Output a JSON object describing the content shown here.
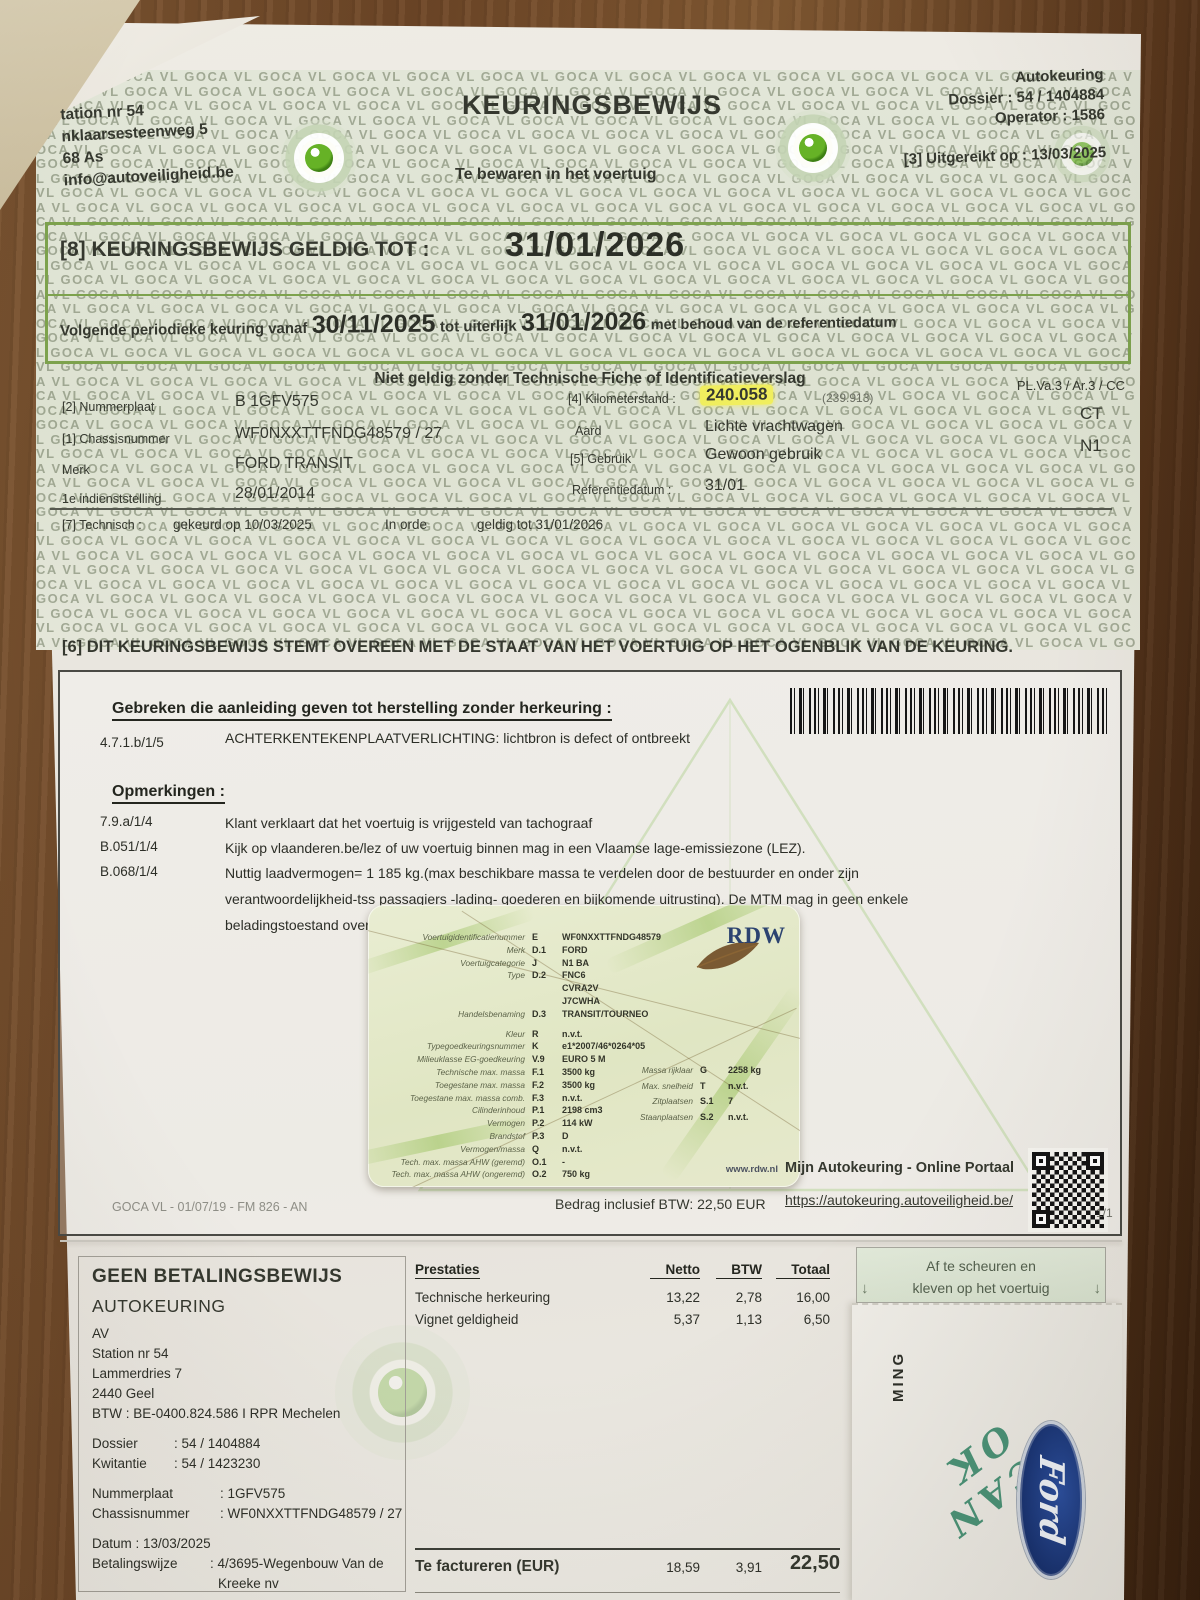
{
  "watermark": {
    "pattern_text": "GOCA VL"
  },
  "header": {
    "station_lines": [
      "tation nr 54",
      "nklaarsesteenweg 5",
      "68 As",
      "info@autoveiligheid.be"
    ],
    "title": "KEURINGSBEWIJS",
    "subtitle": "Te bewaren in het voertuig",
    "org": "Autokeuring",
    "dossier": "Dossier : 54 / 1404884",
    "operator": "Operator : 1586",
    "issued": "[3] Uitgereikt op : 13/03/2025"
  },
  "validity": {
    "label": "[8] KEURINGSBEWIJS GELDIG TOT :",
    "valid_until": "31/01/2026",
    "next_prefix": "Volgende periodieke keuring vanaf",
    "next_from": "30/11/2025",
    "next_mid": "tot uiterlijk",
    "next_until": "31/01/2026",
    "next_suffix": "met behoud van de referentiedatum"
  },
  "notice": "Niet geldig zonder Technische Fiche of Identificatieverslag",
  "vehicle": {
    "plate_label": "[2] Nummerplaat",
    "plate": "B 1GFV575",
    "km_label": "[4] Kilometerstand :",
    "km": "240.058",
    "km_prev": "(239.913)",
    "class_code": "PL.Va.3 / Ar.3 / CC",
    "ct": "CT",
    "n1": "N1",
    "chassis_label": "[1] Chassisnummer",
    "chassis": "WF0NXXTTFNDG48579 / 27",
    "aard_label": "Aard",
    "aard": "Lichte vrachtwagen",
    "merk_label": "Merk",
    "merk": "FORD TRANSIT",
    "gebruik_label": "[5] Gebruik",
    "gebruik": "Gewoon gebruik",
    "firstuse_label": "1e indienststelling",
    "firstuse": "28/01/2014",
    "ref_label": "Referentiedatum :",
    "ref": "31/01"
  },
  "technisch": {
    "label": "[7] Technisch :",
    "gekeurd": "gekeurd op 10/03/2025",
    "status": "In orde",
    "geldig": "geldig tot 31/01/2026"
  },
  "statement": "[6] DIT KEURINGSBEWIJS STEMT OVEREEN MET DE STAAT VAN HET VOERTUIG OP HET OGENBLIK VAN DE KEURING.",
  "defects": {
    "title": "Gebreken die aanleiding geven tot herstelling zonder herkeuring :",
    "rows": [
      {
        "code": "4.7.1.b/1/5",
        "text": "ACHTERKENTEKENPLAATVERLICHTING: lichtbron is defect of ontbreekt"
      }
    ]
  },
  "remarks": {
    "title": "Opmerkingen :",
    "rows": [
      {
        "code": "7.9.a/1/4",
        "text": "Klant verklaart dat het voertuig is vrijgesteld van tachograaf"
      },
      {
        "code": "B.051/1/4",
        "text": "Kijk op vlaanderen.be/lez of uw voertuig binnen mag in een Vlaamse lage-emissiezone (LEZ)."
      },
      {
        "code": "B.068/1/4",
        "text": "Nuttig laadvermogen= 1 185 kg.(max beschikbare massa te verdelen door de bestuurder en onder zijn verantwoordelijkheid-tss passagiers -lading- goederen en bijkomende uitrusting). De MTM mag in geen enkele beladingstoestand overschreden worden."
      }
    ]
  },
  "rdw_card": {
    "brand": "RDW",
    "website": "www.rdw.nl",
    "left_rows": [
      {
        "label": "Voertuigidentificatienummer",
        "code": "E",
        "value": "WF0NXXTTFNDG48579"
      },
      {
        "label": "Merk",
        "code": "D.1",
        "value": "FORD"
      },
      {
        "label": "Voertuigcategorie",
        "code": "J",
        "value": "N1 BA"
      },
      {
        "label": "Type",
        "code": "D.2",
        "value": "FNC6"
      },
      {
        "label": "",
        "code": "",
        "value": "CVRA2V"
      },
      {
        "label": "",
        "code": "",
        "value": "J7CWHA"
      },
      {
        "label": "Handelsbenaming",
        "code": "D.3",
        "value": "TRANSIT/TOURNEO"
      },
      {
        "label": "Kleur",
        "code": "R",
        "value": "n.v.t."
      },
      {
        "label": "Typegoedkeuringsnummer",
        "code": "K",
        "value": "e1*2007/46*0264*05"
      },
      {
        "label": "Milieuklasse EG-goedkeuring",
        "code": "V.9",
        "value": "EURO 5 M"
      },
      {
        "label": "Technische max. massa",
        "code": "F.1",
        "value": "3500 kg"
      },
      {
        "label": "Toegestane max. massa",
        "code": "F.2",
        "value": "3500 kg"
      },
      {
        "label": "Toegestane max. massa comb.",
        "code": "F.3",
        "value": "n.v.t."
      },
      {
        "label": "Cilinderinhoud",
        "code": "P.1",
        "value": "2198 cm3"
      },
      {
        "label": "Vermogen",
        "code": "P.2",
        "value": "114 kW"
      },
      {
        "label": "Brandstof",
        "code": "P.3",
        "value": "D"
      },
      {
        "label": "Vermogen/massa",
        "code": "Q",
        "value": "n.v.t."
      },
      {
        "label": "Tech. max. massa AHW (geremd)",
        "code": "O.1",
        "value": "-"
      },
      {
        "label": "Tech. max. massa AHW (ongeremd)",
        "code": "O.2",
        "value": "750 kg"
      }
    ],
    "right_rows": [
      {
        "label": "Massa rijklaar",
        "code": "G",
        "value": "2258 kg"
      },
      {
        "label": "Max. snelheid",
        "code": "T",
        "value": "n.v.t."
      },
      {
        "label": "Zitplaatsen",
        "code": "S.1",
        "value": "7"
      },
      {
        "label": "Staanplaatsen",
        "code": "S.2",
        "value": "n.v.t."
      }
    ]
  },
  "footer": {
    "bedrag": "Bedrag inclusief BTW: 22,50 EUR",
    "portal_title": "Mijn Autokeuring - Online Portaal",
    "portal_url": "https://autokeuring.autoveiligheid.be/",
    "page": "1/1",
    "form_ref": "GOCA VL - 01/07/19 - FM 826 - AN"
  },
  "receipt": {
    "no_proof": "GEEN BETALINGSBEWIJS",
    "org": "AUTOKEURING",
    "av": "AV",
    "address": [
      "Station nr 54",
      "Lammerdries 7",
      "2440 Geel"
    ],
    "btw": "BTW : BE-0400.824.586 I RPR Mechelen",
    "dossier_label": "Dossier",
    "dossier": ": 54 / 1404884",
    "kwitantie_label": "Kwitantie",
    "kwitantie": ": 54 / 1423230",
    "plate_label": "Nummerplaat",
    "plate": ": 1GFV575",
    "chassis_label": "Chassisnummer",
    "chassis": ": WF0NXXTTFNDG48579 / 27",
    "datum": "Datum : 13/03/2025",
    "betaling_label": "Betalingswijze",
    "betaling": ": 4/3695-Wegenbouw Van de",
    "betaling2": "Kreeke nv",
    "table": {
      "headers": [
        "Prestaties",
        "Netto",
        "BTW",
        "Totaal"
      ],
      "rows": [
        {
          "label": "Technische herkeuring",
          "netto": "13,22",
          "btw": "2,78",
          "totaal": "16,00"
        },
        {
          "label": "Vignet geldigheid",
          "netto": "5,37",
          "btw": "1,13",
          "totaal": "6,50"
        }
      ],
      "total_label": "Te factureren (EUR)",
      "total_netto": "18,59",
      "total_btw": "3,91",
      "total": "22,50"
    },
    "sticker_line1": "Af te scheuren en",
    "sticker_line2": "kleven op het voertuig",
    "vertical_text": "MING",
    "scan_ok": "SCAN OK",
    "ford": "Ford"
  }
}
